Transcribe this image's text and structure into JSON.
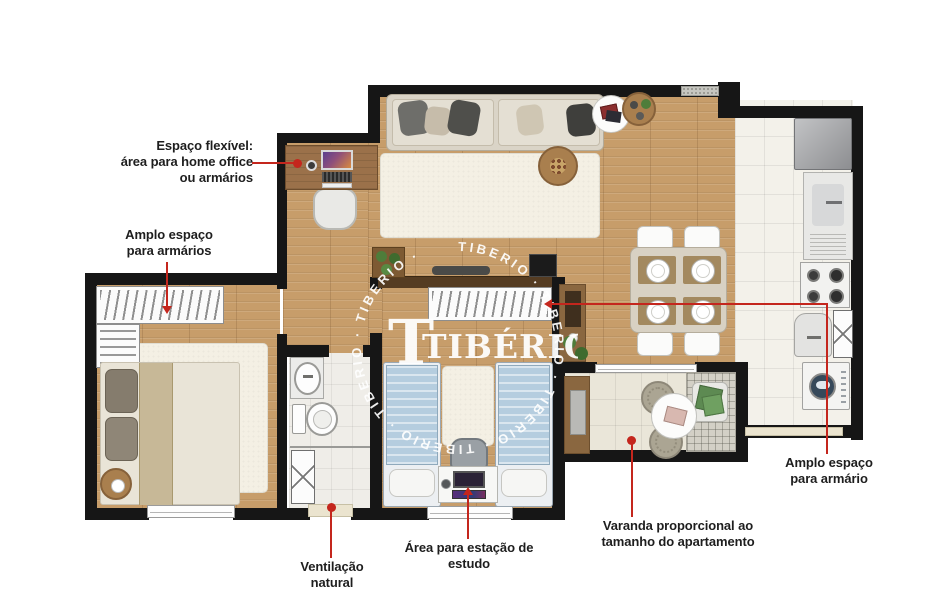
{
  "watermark": {
    "logo_t": "T",
    "logo_text": "TIBÉRIO",
    "ring_text": "TIBERIO · TIBERIO · TIBERIO · TIBERIO · TIBERIO · TIBERIO ·"
  },
  "annotations": {
    "flex_space": {
      "line1": "Espaço flexível:",
      "line2": "área para home office",
      "line3": "ou armários"
    },
    "closet_left": {
      "line1": "Amplo espaço",
      "line2": "para armários"
    },
    "ventilation": {
      "line1": "Ventilação",
      "line2": "natural"
    },
    "study_area": {
      "line1": "Área para estação de",
      "line2": "estudo"
    },
    "balcony": {
      "line1": "Varanda proporcional ao",
      "line2": "tamanho do apartamento"
    },
    "closet_right": {
      "line1": "Amplo espaço",
      "line2": "para armário"
    }
  },
  "palette": {
    "annotation_red": "#c4261d",
    "wall_black": "#161616",
    "wood_floor": "#c79d6a",
    "label_text": "#1e1e1e",
    "watermark_white": "#ffffff"
  }
}
